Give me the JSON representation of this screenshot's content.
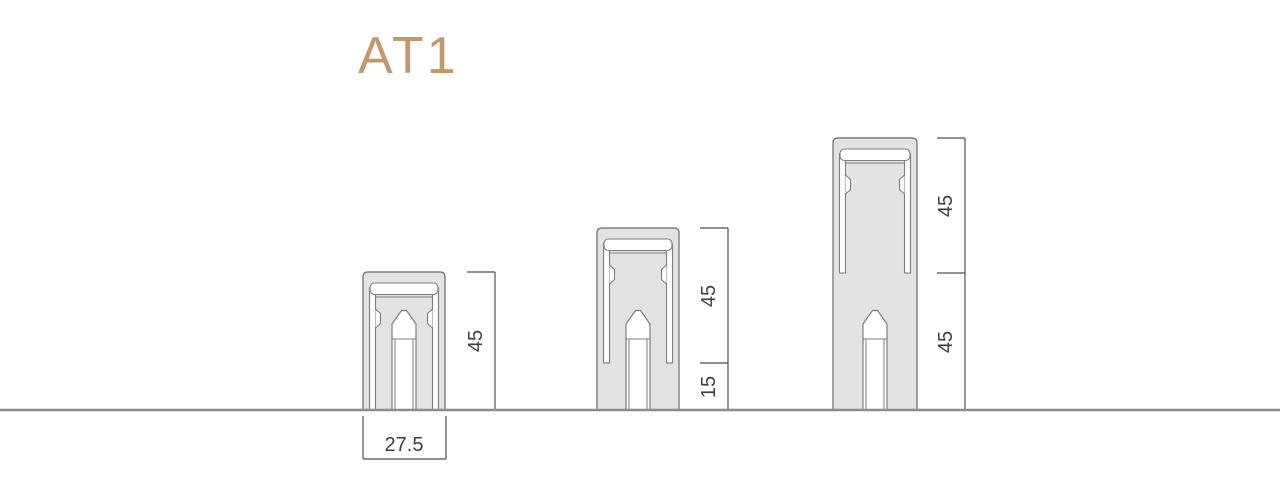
{
  "title": {
    "text": "AT1",
    "color": "#c3986b"
  },
  "colors": {
    "profile_fill": "#e3e3e3",
    "profile_stroke": "#7e7e7e",
    "dimension_line": "#4f4f4f",
    "dimension_text": "#3f3f3f",
    "ground_line": "#8c8c8c",
    "background": "#ffffff"
  },
  "ground_y": 410,
  "width_dim": {
    "label": "27.5",
    "x1": 363,
    "x2": 446,
    "ext_top_y": 416,
    "bottom_y": 459,
    "text_x": 404,
    "text_y": 451
  },
  "profiles": [
    {
      "id": "45",
      "total_height_label": "45",
      "left": 363,
      "top": 272,
      "width": 82,
      "strip_end": 410,
      "dim": {
        "line_x": 495,
        "tick_len": 28,
        "ticks": [
          272
        ],
        "labels": [
          {
            "text": "45",
            "y": 341
          }
        ]
      }
    },
    {
      "id": "60",
      "total_height_label": "45+15",
      "left": 597,
      "top": 228,
      "width": 82,
      "strip_end": 363,
      "dim": {
        "line_x": 728,
        "tick_len": 28,
        "ticks": [
          228,
          363
        ],
        "labels": [
          {
            "text": "45",
            "y": 296
          },
          {
            "text": "15",
            "y": 387
          }
        ]
      }
    },
    {
      "id": "90",
      "total_height_label": "45+45",
      "left": 833,
      "top": 138,
      "width": 84,
      "strip_end": 273,
      "dim": {
        "line_x": 965,
        "tick_len": 28,
        "ticks": [
          138,
          273
        ],
        "labels": [
          {
            "text": "45",
            "y": 206
          },
          {
            "text": "45",
            "y": 342
          }
        ]
      }
    }
  ]
}
